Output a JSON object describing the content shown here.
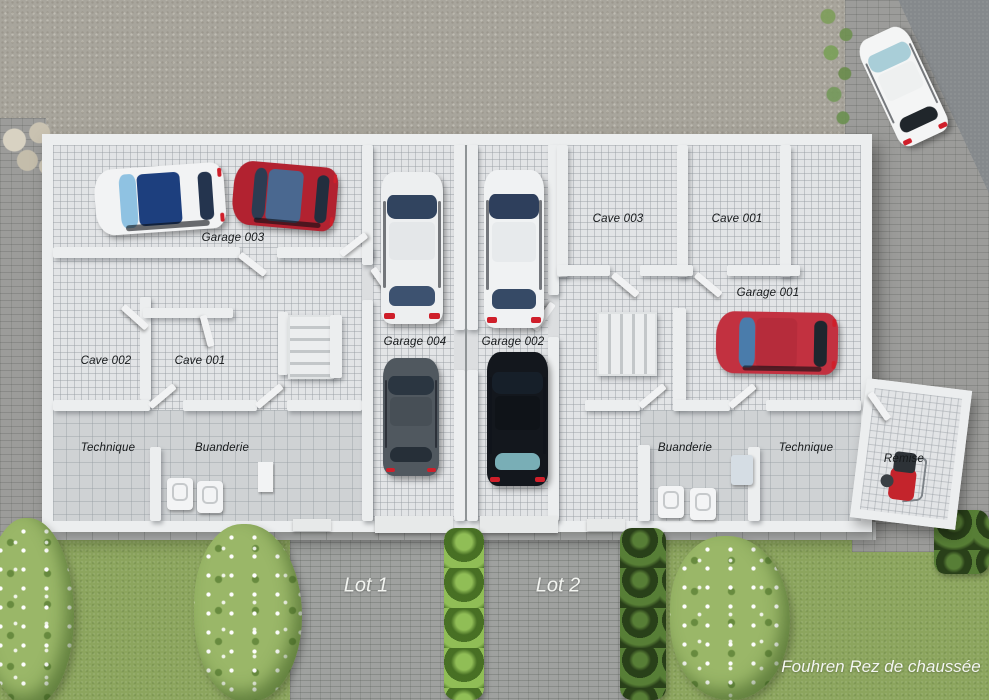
{
  "plan": {
    "caption": "Fouhren Rez de chaussée",
    "lots": [
      {
        "label": "Lot 1"
      },
      {
        "label": "Lot 2"
      }
    ],
    "rooms": [
      {
        "label": "Garage 003"
      },
      {
        "label": "Cave 002"
      },
      {
        "label": "Cave 001"
      },
      {
        "label": "Technique"
      },
      {
        "label": "Buanderie"
      },
      {
        "label": "Garage 004"
      },
      {
        "label": "Garage 002"
      },
      {
        "label": "Cave 003"
      },
      {
        "label": "Cave 001"
      },
      {
        "label": "Garage 001"
      },
      {
        "label": "Buanderie"
      },
      {
        "label": "Technique"
      },
      {
        "label": "Remise"
      }
    ]
  },
  "vehicles": [
    {
      "name": "white-coupe",
      "location": "Garage 003",
      "body": "#f2f3f4",
      "glass": "#8fc2e2",
      "roof": "#1d3f7e",
      "rear": "#24344e"
    },
    {
      "name": "red-hatchback",
      "location": "Garage 003",
      "body": "#b22230",
      "glass": "#2c3c52",
      "roof": "#4a6890",
      "rear": "#222e3e"
    },
    {
      "name": "white-sedan",
      "location": "Garage 004",
      "body": "#edeff0",
      "glass": "#31445f",
      "roof": "#e4e7e9",
      "rear": "#3d5270"
    },
    {
      "name": "grey-sedan",
      "location": "Garage 004",
      "body": "#50585f",
      "glass": "#2b3641",
      "roof": "#474f56",
      "rear": "#262f38"
    },
    {
      "name": "white-sedan",
      "location": "Garage 002",
      "body": "#f0f2f3",
      "glass": "#2e3f5c",
      "roof": "#e7eaec",
      "rear": "#364a66"
    },
    {
      "name": "black-suv",
      "location": "Garage 002",
      "body": "#13171d",
      "glass": "#161f29",
      "roof": "#0f1318",
      "rear": "#79aeb6"
    },
    {
      "name": "red-suv",
      "location": "Garage 001",
      "body": "#c23140",
      "glass": "#4a7cab",
      "roof": "#b62c3b",
      "rear": "#1e262e"
    },
    {
      "name": "white-city-car",
      "location": "street",
      "body": "#f4f5f5",
      "glass": "#a9ced8",
      "roof": "#eef0f0",
      "rear": "#20262b"
    }
  ],
  "env": {
    "gravel": "#a8a59c",
    "pavers": "#9c9c9a",
    "asphalt": "#85898c",
    "driveway": "#9fa19f",
    "grass": "#8ca55e",
    "hedge": "#5f8c33",
    "bush": "#9ab768",
    "walkway": "#c7c9c8",
    "floor": "#e2e4e6",
    "floor-line": "rgba(150,156,162,0.45)",
    "coarse-floor": "#cfd2d4",
    "wall": "#eceeef",
    "seam": "#8f9496"
  }
}
